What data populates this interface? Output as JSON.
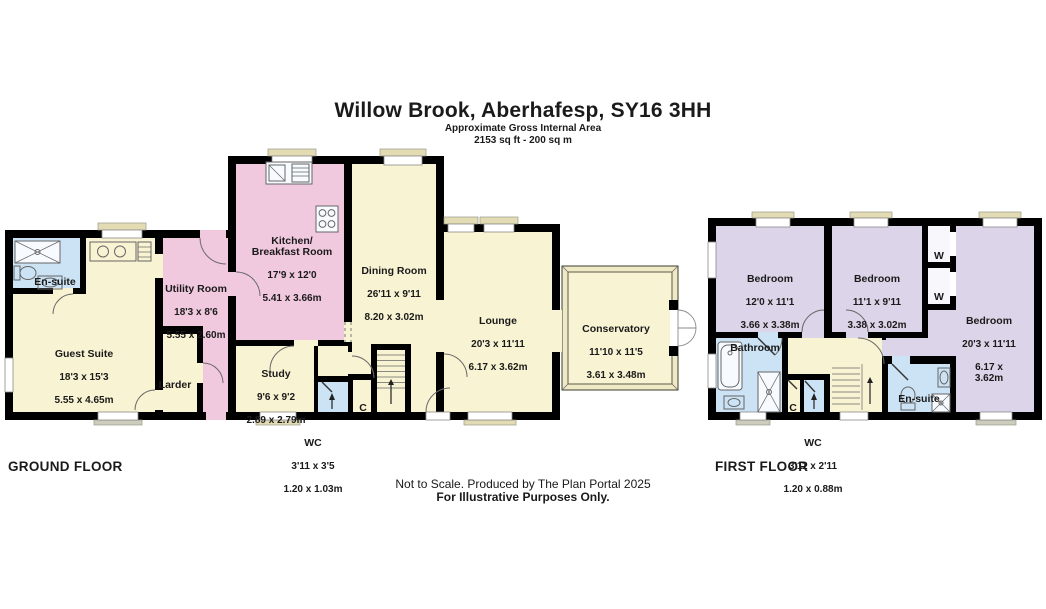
{
  "header": {
    "title": "Willow Brook, Aberhafesp, SY16 3HH",
    "subtitle1": "Approximate Gross Internal Area",
    "subtitle2": "2153 sq ft - 200 sq m"
  },
  "footer": {
    "line1": "Not to Scale. Produced by The Plan Portal 2025",
    "line2": "For Illustrative Purposes Only."
  },
  "floors": {
    "ground": {
      "label": "GROUND FLOOR",
      "rooms": {
        "ensuite": {
          "name": "En-suite"
        },
        "guest_suite": {
          "name": "Guest Suite",
          "imperial": "18'3 x 15'3",
          "metric": "5.55 x 4.65m"
        },
        "utility": {
          "name": "Utility Room",
          "imperial": "18'3 x 8'6",
          "metric": "5.55 x 2.60m"
        },
        "larder": {
          "name": "Larder"
        },
        "kitchen": {
          "name": "Kitchen/\nBreakfast Room",
          "imperial": "17'9 x 12'0",
          "metric": "5.41 x 3.66m"
        },
        "dining": {
          "name": "Dining Room",
          "imperial": "26'11 x 9'11",
          "metric": "8.20 x 3.02m"
        },
        "study": {
          "name": "Study",
          "imperial": "9'6 x 9'2",
          "metric": "2.89 x 2.79m"
        },
        "lounge": {
          "name": "Lounge",
          "imperial": "20'3 x 11'11",
          "metric": "6.17 x 3.62m"
        },
        "conservatory": {
          "name": "Conservatory",
          "imperial": "11'10 x 11'5",
          "metric": "3.61 x 3.48m"
        },
        "wc": {
          "name": "WC",
          "imperial": "3'11 x 3'5",
          "metric": "1.20 x 1.03m"
        },
        "cupboard": {
          "name": "C"
        }
      }
    },
    "first": {
      "label": "FIRST FLOOR",
      "rooms": {
        "bedroom1": {
          "name": "Bedroom",
          "imperial": "12'0 x 11'1",
          "metric": "3.66 x 3.38m"
        },
        "bedroom2": {
          "name": "Bedroom",
          "imperial": "11'1 x 9'11",
          "metric": "3.38 x 3.02m"
        },
        "bedroom3": {
          "name": "Bedroom",
          "imperial": "20'3 x 11'11",
          "metric": "6.17 x 3.62m"
        },
        "bathroom": {
          "name": "Bathroom"
        },
        "ensuite": {
          "name": "En-suite"
        },
        "wc": {
          "name": "WC",
          "imperial": "3'11 x 2'11",
          "metric": "1.20 x 0.88m"
        },
        "cupboard": {
          "name": "C"
        },
        "wardrobe1": {
          "name": "W"
        },
        "wardrobe2": {
          "name": "W"
        }
      }
    }
  },
  "colors": {
    "wall": "#000000",
    "room_cream": "#F8F3D2",
    "room_pink": "#F1C9DF",
    "room_blue": "#CBE3F4",
    "room_purple": "#DCD5E9",
    "window_sill": "#E2DBB4",
    "text": "#1A1A1A"
  }
}
